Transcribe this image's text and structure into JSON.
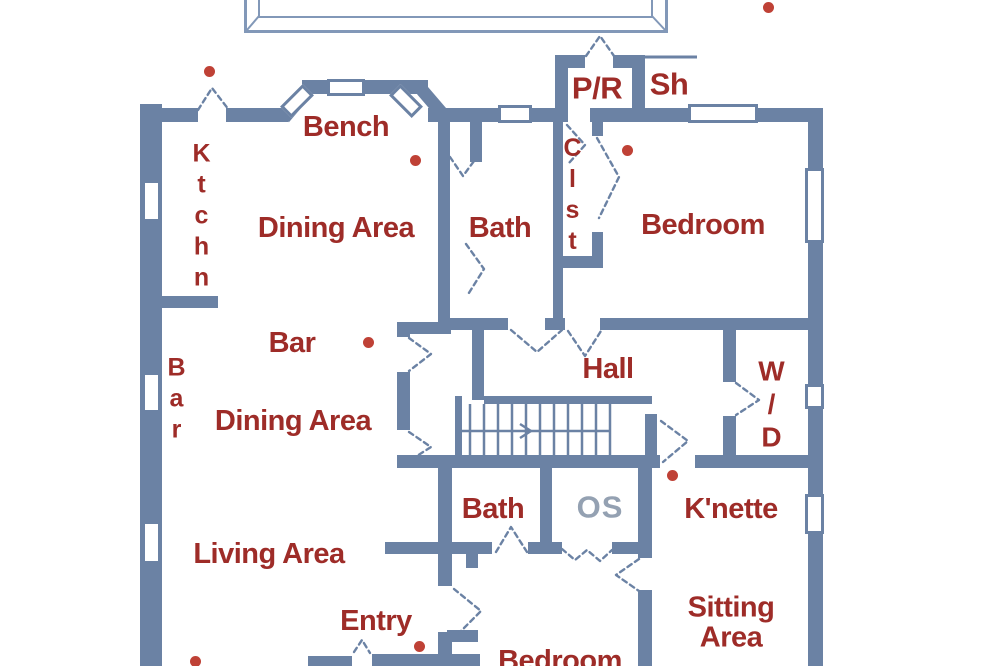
{
  "floorplan": {
    "colors": {
      "wall": "#6b82a4",
      "deck_outline": "#8298b8",
      "label_red": "#9e2c28",
      "label_gray": "#94a1b2",
      "dot_red": "#bf4136"
    },
    "rooms": {
      "bench": "Bench",
      "ktchn": "Ktchn",
      "dining_upper": "Dining Area",
      "bath_upper": "Bath",
      "clst": "Clst",
      "bedroom_upper": "Bedroom",
      "pr": "P/R",
      "sh": "Sh",
      "bar_h": "Bar",
      "bar_v": "Bar",
      "dining_lower": "Dining Area",
      "hall": "Hall",
      "wd": "W/D",
      "bath_lower": "Bath",
      "os": "OS",
      "knette": "K'nette",
      "living": "Living Area",
      "entry": "Entry",
      "bedroom_lower": "Bedroom",
      "sitting1": "Sitting",
      "sitting2": "Area"
    }
  }
}
